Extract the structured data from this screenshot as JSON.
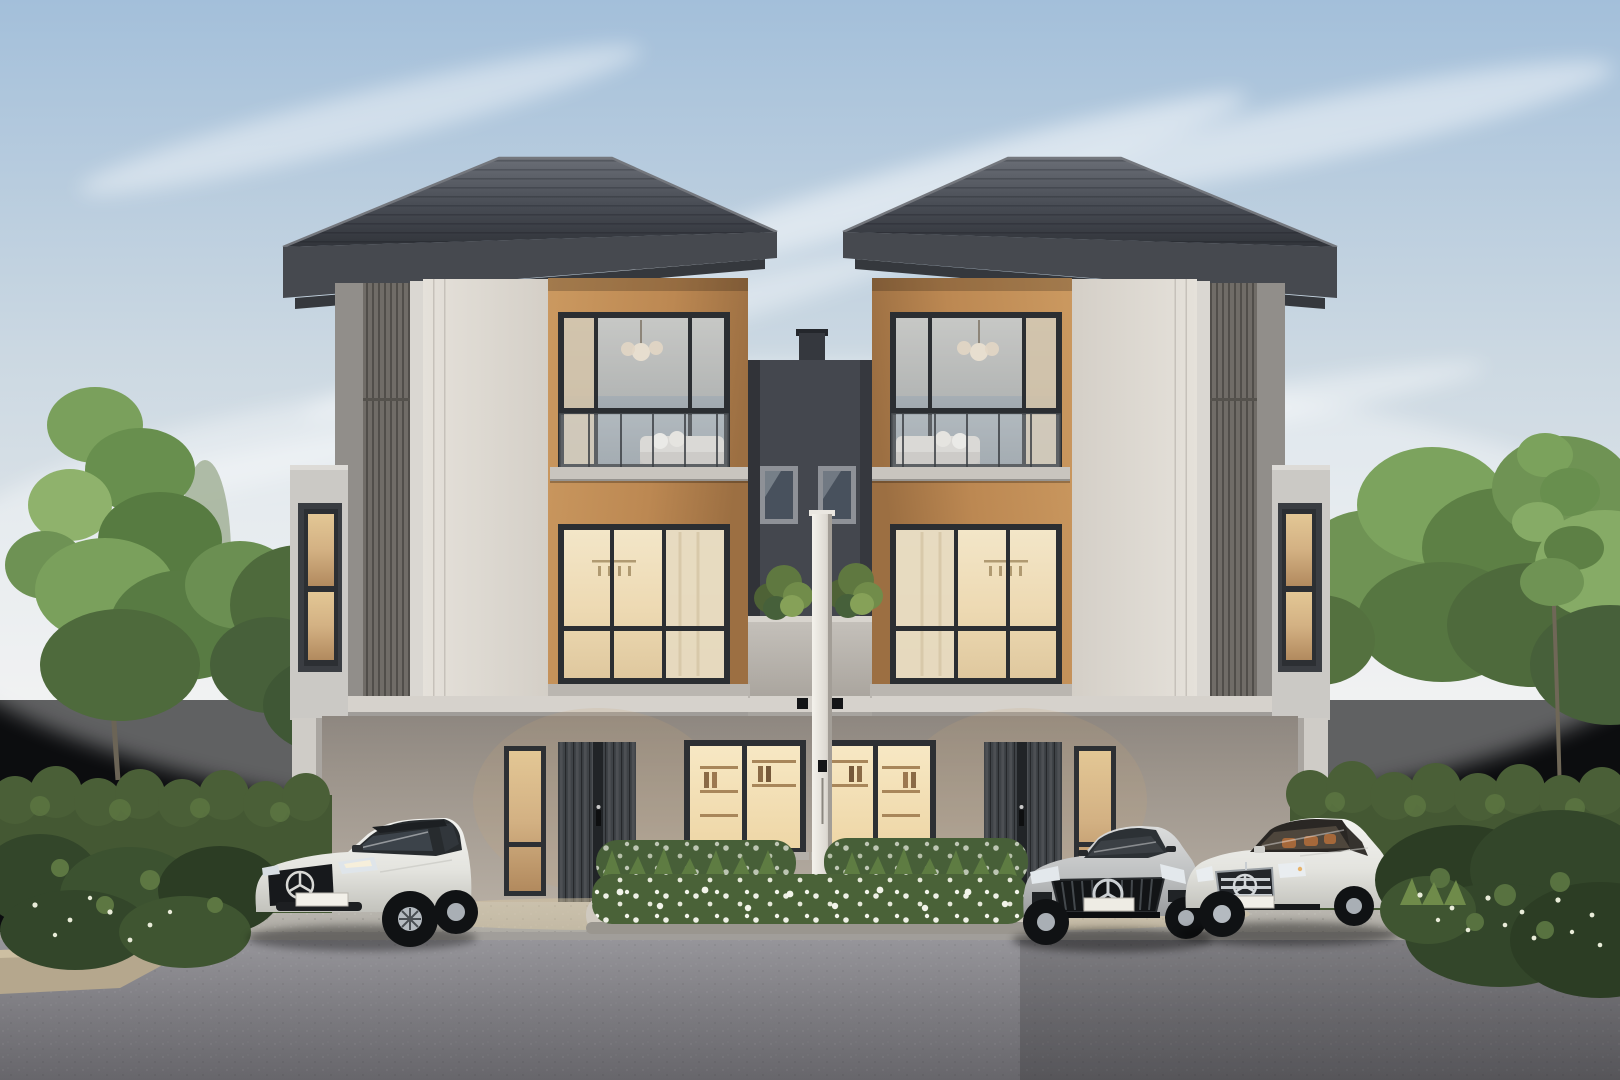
{
  "scene": {
    "type": "architectural-exterior-rendering",
    "description": "Photorealistic rendering of twin mirrored three-storey modern townhouses with dark hip roofs, cream and ribbed grey facades, warm orange window surrounds, glowing interior lights, a dark recessed link block between the units, landscaped hedges and trees on both sides, a white flower bed in the centre driveway, and three luxury cars parked in front.",
    "counts": {
      "houses": 2,
      "floors_per_house": 3,
      "cars": 3
    }
  },
  "palette": {
    "skyTop": "#a3bfda",
    "skyHorizon": "#e9ebec",
    "cloud": "#ffffff",
    "roofLight": "#6a6e76",
    "roofDark": "#31343a",
    "fascia": "#46494f",
    "wallCream": "#e5e1da",
    "wallCreamShade": "#d4cfc7",
    "wallSideReturn": "#918e8a",
    "ribbedPanel": "#706c67",
    "accentOrange": "#cb9960",
    "accentOrangeShadow": "#9c6f42",
    "darkCore": "#44474e",
    "windowFrame": "#2b2e32",
    "glassCool": "#aab2b8",
    "glassWarmHi": "#f3e6c8",
    "glassWarmLo": "#dfc89e",
    "glowAmber": "#d3b183",
    "groundWallDark": "#8e8780",
    "groundWallLight": "#b7aea3",
    "canopy": "#d6d2cc",
    "pillar": "#f4f2ec",
    "parapet": "#c6c2bc",
    "driveway": "#b3b0a9",
    "roadLight": "#96959a",
    "roadDark": "#67666b",
    "curbStone": "#b5a78d",
    "hedge": "#445833",
    "hedgeDark": "#33462a",
    "treeGreen": "#6e9254",
    "treeGreenDark": "#4e6a3c",
    "flowerWhite": "#eef0e6",
    "carWhiteHi": "#f4f4f1",
    "carWhiteLo": "#c2c2bc",
    "carSilverHi": "#dcdddd",
    "carSilverLo": "#97999b",
    "carGlass": "#343a40",
    "interiorTan": "#a5683a",
    "doorGrey": "#3f4347"
  },
  "houses": {
    "left": {
      "label": "left townhouse unit",
      "features": [
        "hip roof",
        "third-floor bedroom window with glass balustrade",
        "second-floor lit window with curtain",
        "entrance door with vertical slats",
        "narrow glowing sidelight window",
        "ground-floor bookshelf window",
        "carport column"
      ]
    },
    "right": {
      "label": "right townhouse unit (mirrored)",
      "features": [
        "hip roof",
        "third-floor window with pendant light and artwork",
        "second-floor lit window",
        "entrance door with vertical slats",
        "narrow glowing sidelight window",
        "ground-floor bookshelf window",
        "carport column"
      ]
    },
    "link": {
      "label": "dark recessed link block",
      "features": [
        "chimney stub",
        "two small windows",
        "planted balcony ledge",
        "central white party-wall pillar",
        "two vent squares"
      ]
    }
  },
  "cars": [
    {
      "name": "white-suv-coupe",
      "color": "white",
      "position": "front of left unit"
    },
    {
      "name": "silver-sport-sedan",
      "color": "silver grey",
      "position": "front of right unit, left bay"
    },
    {
      "name": "white-luxury-sedan",
      "color": "white",
      "position": "front of right unit, right bay"
    }
  ],
  "landscape": {
    "left": [
      "tall slender tree",
      "leafy tree cluster",
      "trimmed hedge",
      "flowering shrubs"
    ],
    "right": [
      "leafy tree cluster",
      "tall slender tree",
      "trimmed hedge",
      "dark shrub bank with white blossoms"
    ],
    "center": [
      "white flower bed with spiky grasses and stone kerb"
    ]
  }
}
